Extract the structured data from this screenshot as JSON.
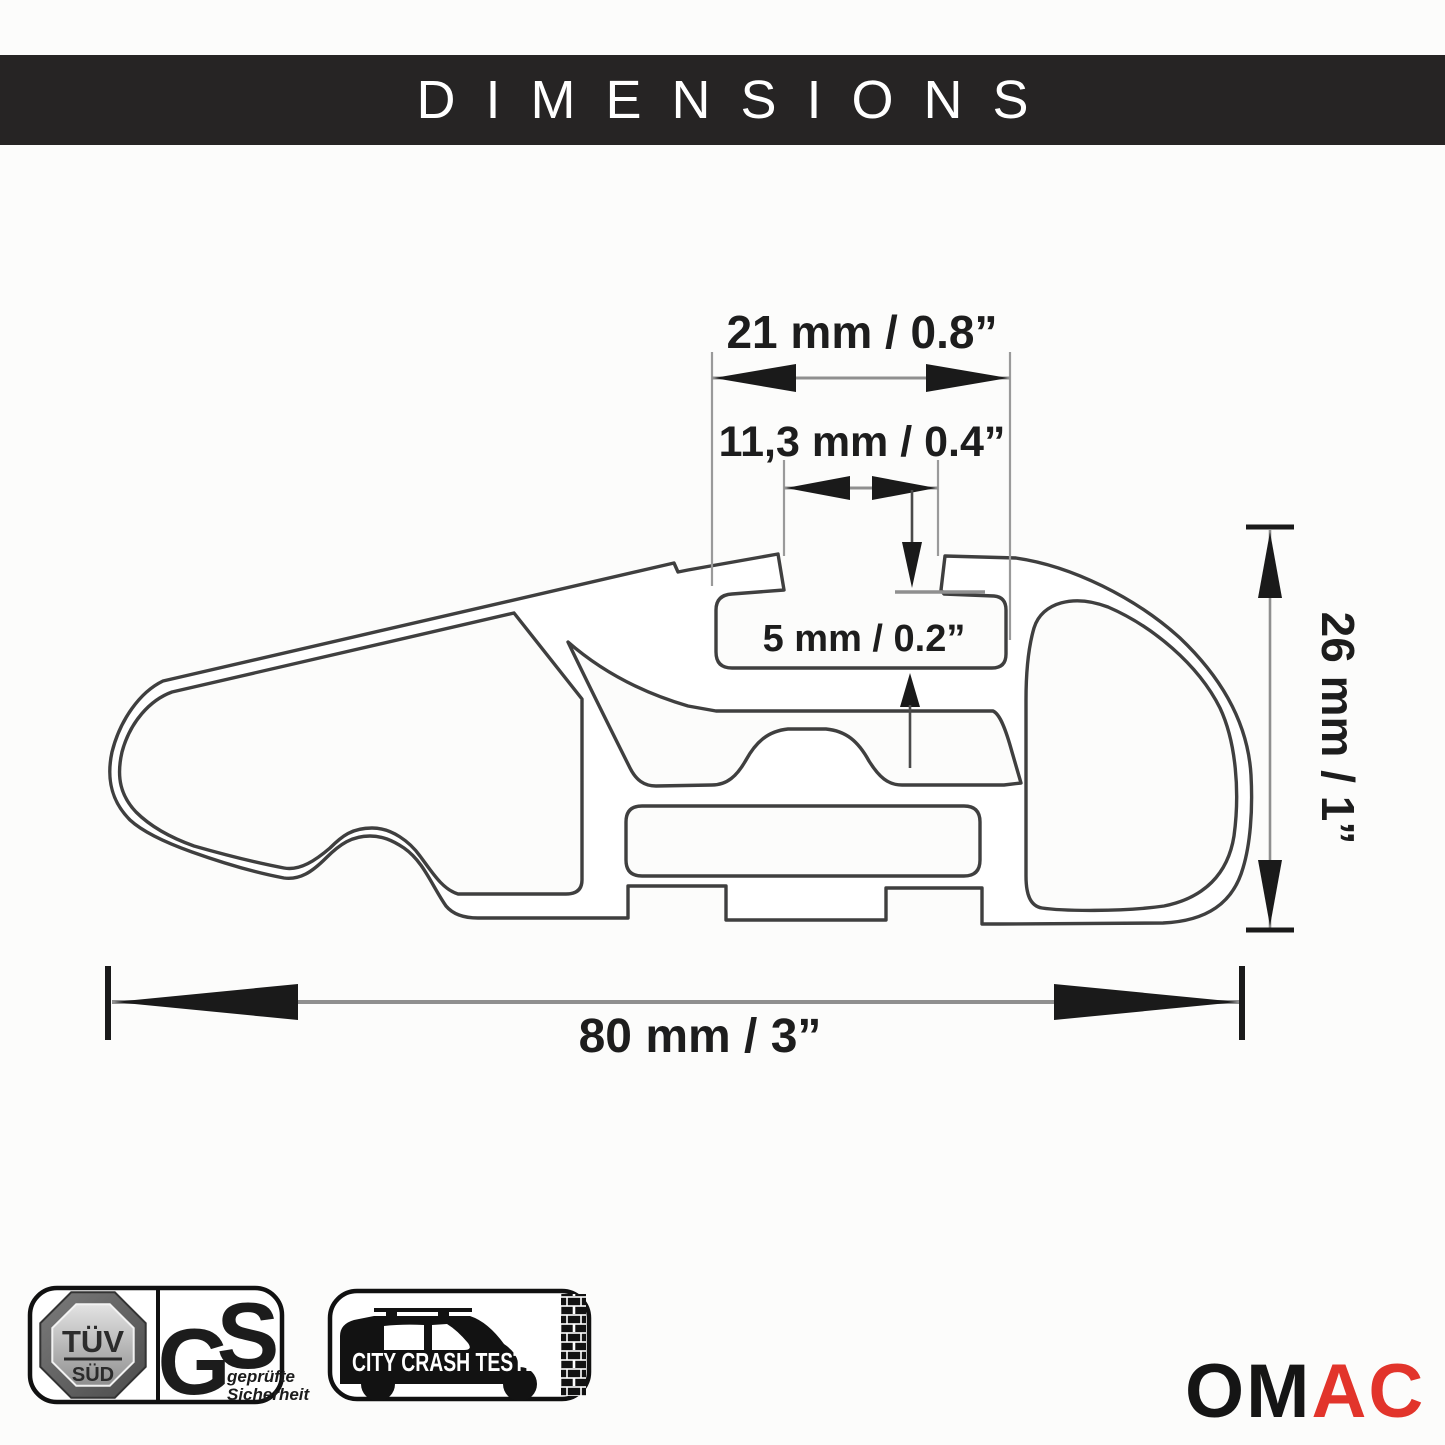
{
  "header": {
    "title": "DIMENSIONS"
  },
  "diagram": {
    "type": "technical-cross-section",
    "subject": "roof rack crossbar aluminum profile",
    "labels": {
      "dim_top_width": "21 mm / 0.8”",
      "dim_slot_opening": "11,3 mm / 0.4”",
      "dim_slot_depth": "5 mm / 0.2”",
      "dim_height": "26 mm / 1”",
      "dim_total_width": "80 mm / 3”"
    },
    "measurements": [
      {
        "name": "channel width",
        "mm": "21",
        "inch": "0.8"
      },
      {
        "name": "slot opening",
        "mm": "11,3",
        "inch": "0.4"
      },
      {
        "name": "slot depth",
        "mm": "5",
        "inch": "0.2"
      },
      {
        "name": "profile height",
        "mm": "26",
        "inch": "1"
      },
      {
        "name": "profile width",
        "mm": "80",
        "inch": "3"
      }
    ]
  },
  "badges": {
    "tuv": {
      "line1": "TÜV",
      "line2": "SÜD"
    },
    "gs": {
      "letter_g": "G",
      "letter_s": "S",
      "caption_line1": "geprüfte",
      "caption_line2": "Sicherheit"
    },
    "crash": {
      "label": "CITY CRASH TESTED"
    }
  },
  "brand": {
    "name_black": "OM",
    "name_red": "AC"
  },
  "colors": {
    "header_bg": "#262424",
    "header_text": "#ffffff",
    "line": "#3f3f3f",
    "dim_line": "#8f8f8f",
    "arrow": "#1a1a1a",
    "brand_red": "#e2342b"
  }
}
